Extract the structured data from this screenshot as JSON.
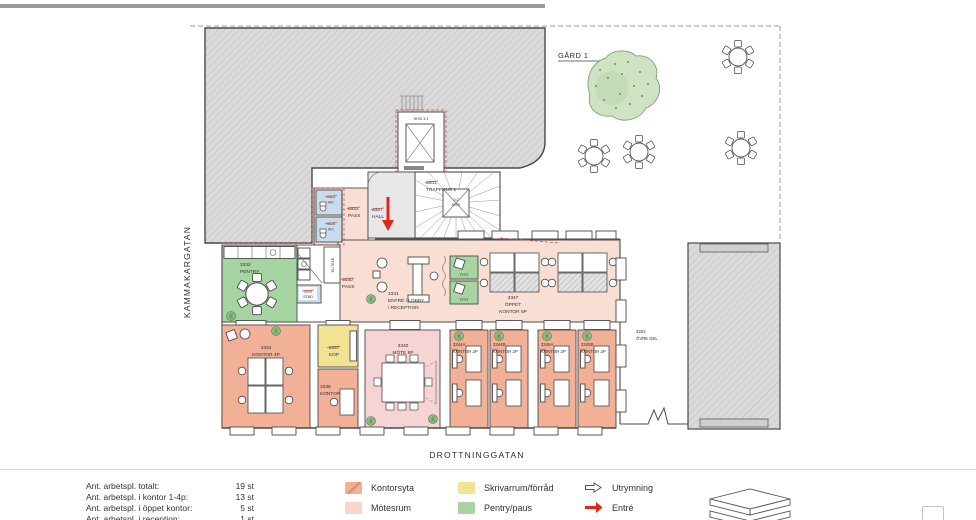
{
  "palette": {
    "kontor": "#F2B096",
    "korridor": "#F9DED3",
    "motesrum": "#F6D3D4",
    "skrivarrum": "#F1E294",
    "pentry": "#A7D5A1",
    "wc": "#C9DCEC",
    "hall": "#E7E7E7",
    "entre_red": "#E0251B"
  },
  "plan": {
    "street_left": "KAMMAKARGATAN",
    "street_bottom": "DROTTNINGGATAN",
    "courtyard": "GÅRD 1"
  },
  "rooms": {
    "hiss": {
      "l1": "HISS 3:1"
    },
    "hiss2": {
      "l1": "3:2",
      "l2": "HISS"
    },
    "trapphus": {
      "l1": "3301",
      "l2": "TRAPPHUS 1"
    },
    "hall": {
      "l1": "3327",
      "l2": "HALL"
    },
    "pass3322": {
      "l1": "3322",
      "l2": "PASS"
    },
    "wc3323": {
      "l1": "3323",
      "l2": "WC"
    },
    "wc3326": {
      "l1": "3326",
      "l2": "WC"
    },
    "stad": {
      "l1": "3328",
      "l2": "STÄD"
    },
    "eltele": {
      "l1": "EL/TELE"
    },
    "pentry": {
      "l1": "3332",
      "l2": "PENTRY"
    },
    "pass3330": {
      "l1": "3330",
      "l2": "PASS"
    },
    "entre": {
      "l1": "3331",
      "l2": "ENTRÉ / LOBBY",
      "l3": "/ RECEPTION"
    },
    "oppet": {
      "l1": "3347",
      "l2": "ÖPPET",
      "l3": "KONTOR 5P"
    },
    "tyst1": {
      "l1": "TYST"
    },
    "tyst2": {
      "l1": "TYST"
    },
    "kontor3334": {
      "l1": "3334",
      "l2": "KONTOR 4P"
    },
    "kop": {
      "l1": "3337",
      "l2": "KOP"
    },
    "kontor3338": {
      "l1": "3338",
      "l2": "KONTOR"
    },
    "mote": {
      "l1": "3340",
      "l2": "MÖTE 8P"
    },
    "k3344a": {
      "l1": "3344A",
      "l2": "KONTOR 2P"
    },
    "k3344b": {
      "l1": "3344B",
      "l2": "KONTOR 2P"
    },
    "k3345a": {
      "l1": "3345A",
      "l2": "KONTOR 2P"
    },
    "k3345b": {
      "l1": "3345B",
      "l2": "KONTOR 2P"
    },
    "ovredel": {
      "l1": "3253",
      "l2": "ÖVRE DEL"
    }
  },
  "legend": {
    "items": [
      {
        "label": "Kontorsyta",
        "color": "#F2B096"
      },
      {
        "label": "Mötesrum",
        "color": "#F8D5C9"
      },
      {
        "label": "Skrivarrum/förråd",
        "color": "#F1E294"
      },
      {
        "label": "Pentry/paus",
        "color": "#A7D5A1"
      },
      {
        "label": "Utrymning"
      },
      {
        "label": "Entré",
        "color": "#E0251B"
      }
    ]
  },
  "stats": {
    "rows": [
      {
        "label": "Ant. arbetspl. totalt:",
        "value": "19 st"
      },
      {
        "label": "Ant. arbetspl. i kontor 1-4p:",
        "value": "13 st"
      },
      {
        "label": "Ant. arbetspl. i öppet kontor:",
        "value": "5 st"
      },
      {
        "label": "Ant. arbetspl. i reception:",
        "value": "1 st"
      }
    ]
  }
}
